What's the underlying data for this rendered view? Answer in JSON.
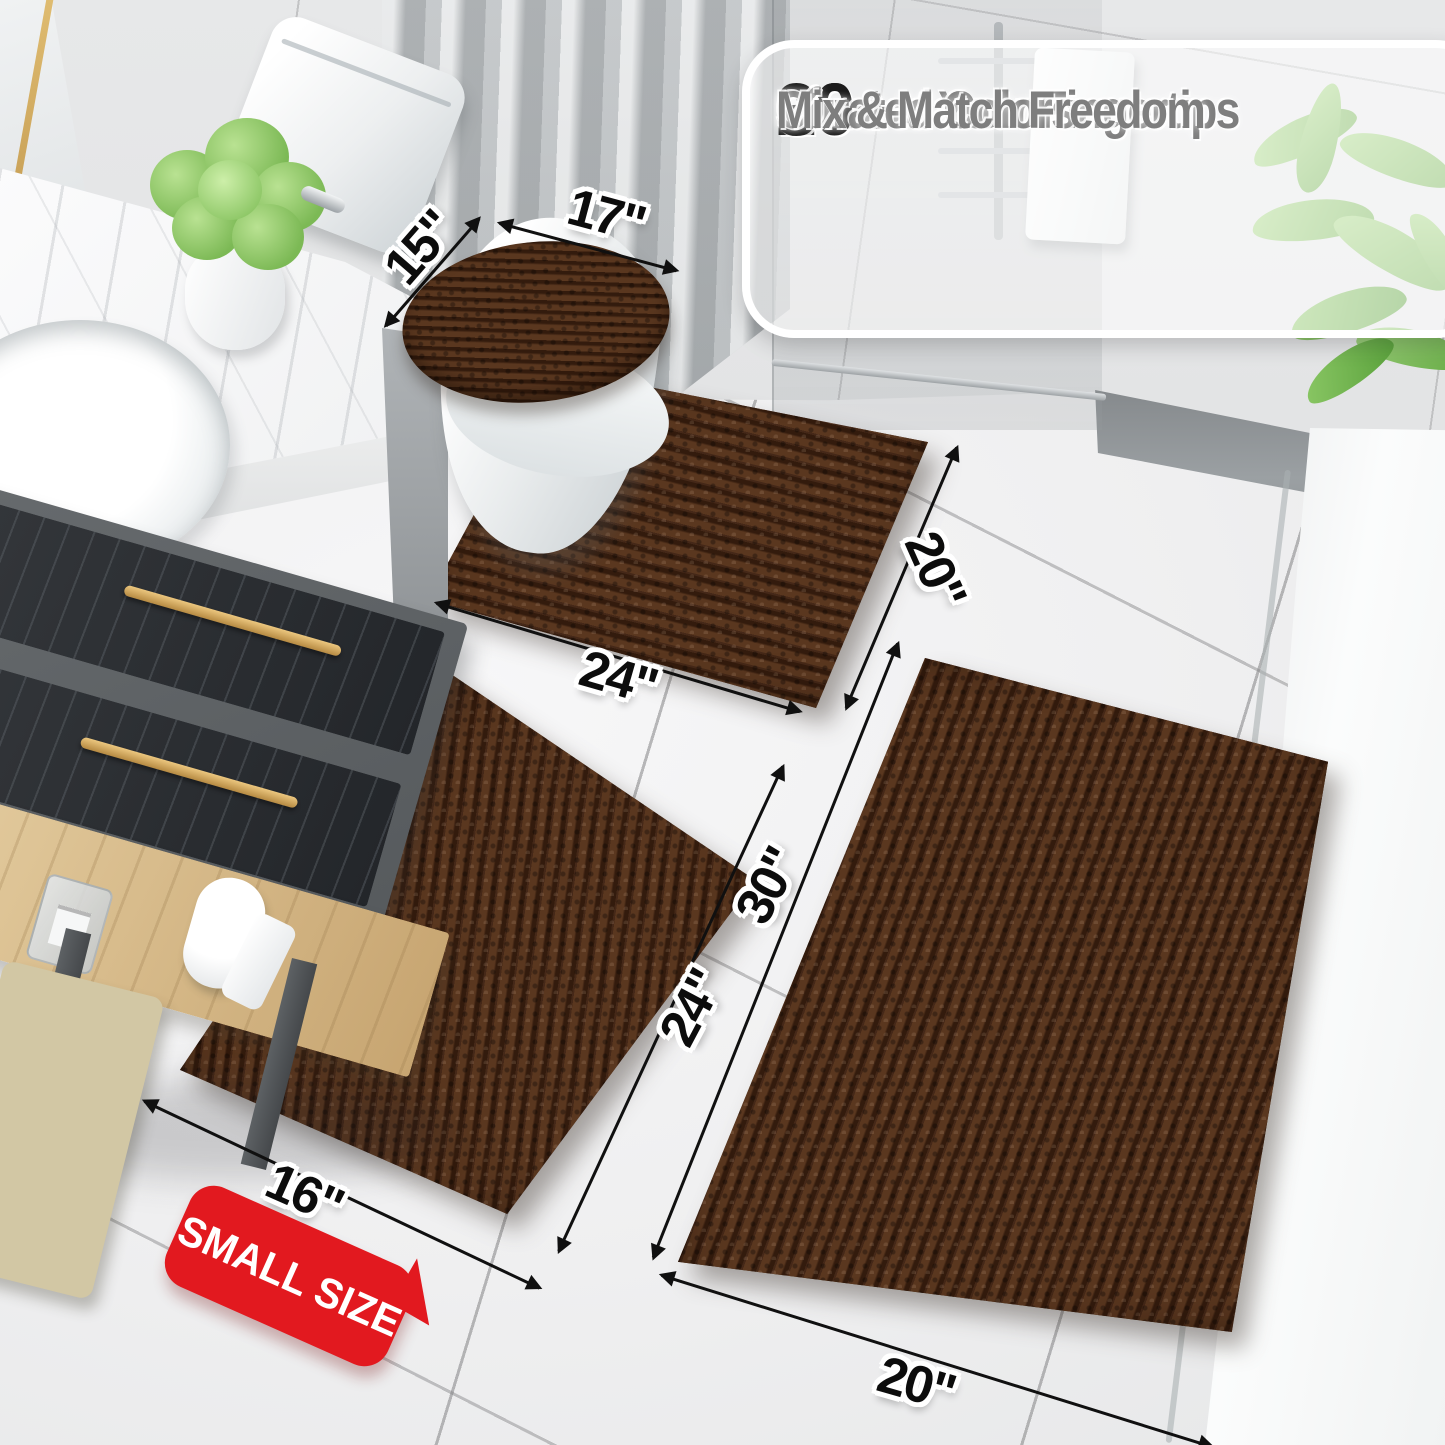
{
  "feature_box": {
    "check_glyph": "✓",
    "rows": [
      {
        "icon": "check-icon",
        "stat": "20+",
        "label": "Sizes at Your Fingertips"
      },
      {
        "icon": "check-icon",
        "stat": "30+",
        "label": "Curated Colors"
      },
      {
        "icon": "check-icon",
        "stat": "",
        "label": "Mix & Match Freedom"
      }
    ]
  },
  "dimension_labels": {
    "lid_cover_depth": "15\"",
    "lid_cover_width": "17\"",
    "contour_rug_width": "24\"",
    "contour_rug_depth": "20\"",
    "small_rug_length": "24\"",
    "small_rug_width": "16\"",
    "large_rug_length": "30\"",
    "large_rug_width": "20\""
  },
  "badge": {
    "label": "SMALL SIZE"
  },
  "colors": {
    "rug_brown": "#452818",
    "badge_red": "#e2191f",
    "gold_accent": "#c9a050",
    "stat_text": "#1b1b1b",
    "feature_gray_text": "#7e7e7e"
  }
}
